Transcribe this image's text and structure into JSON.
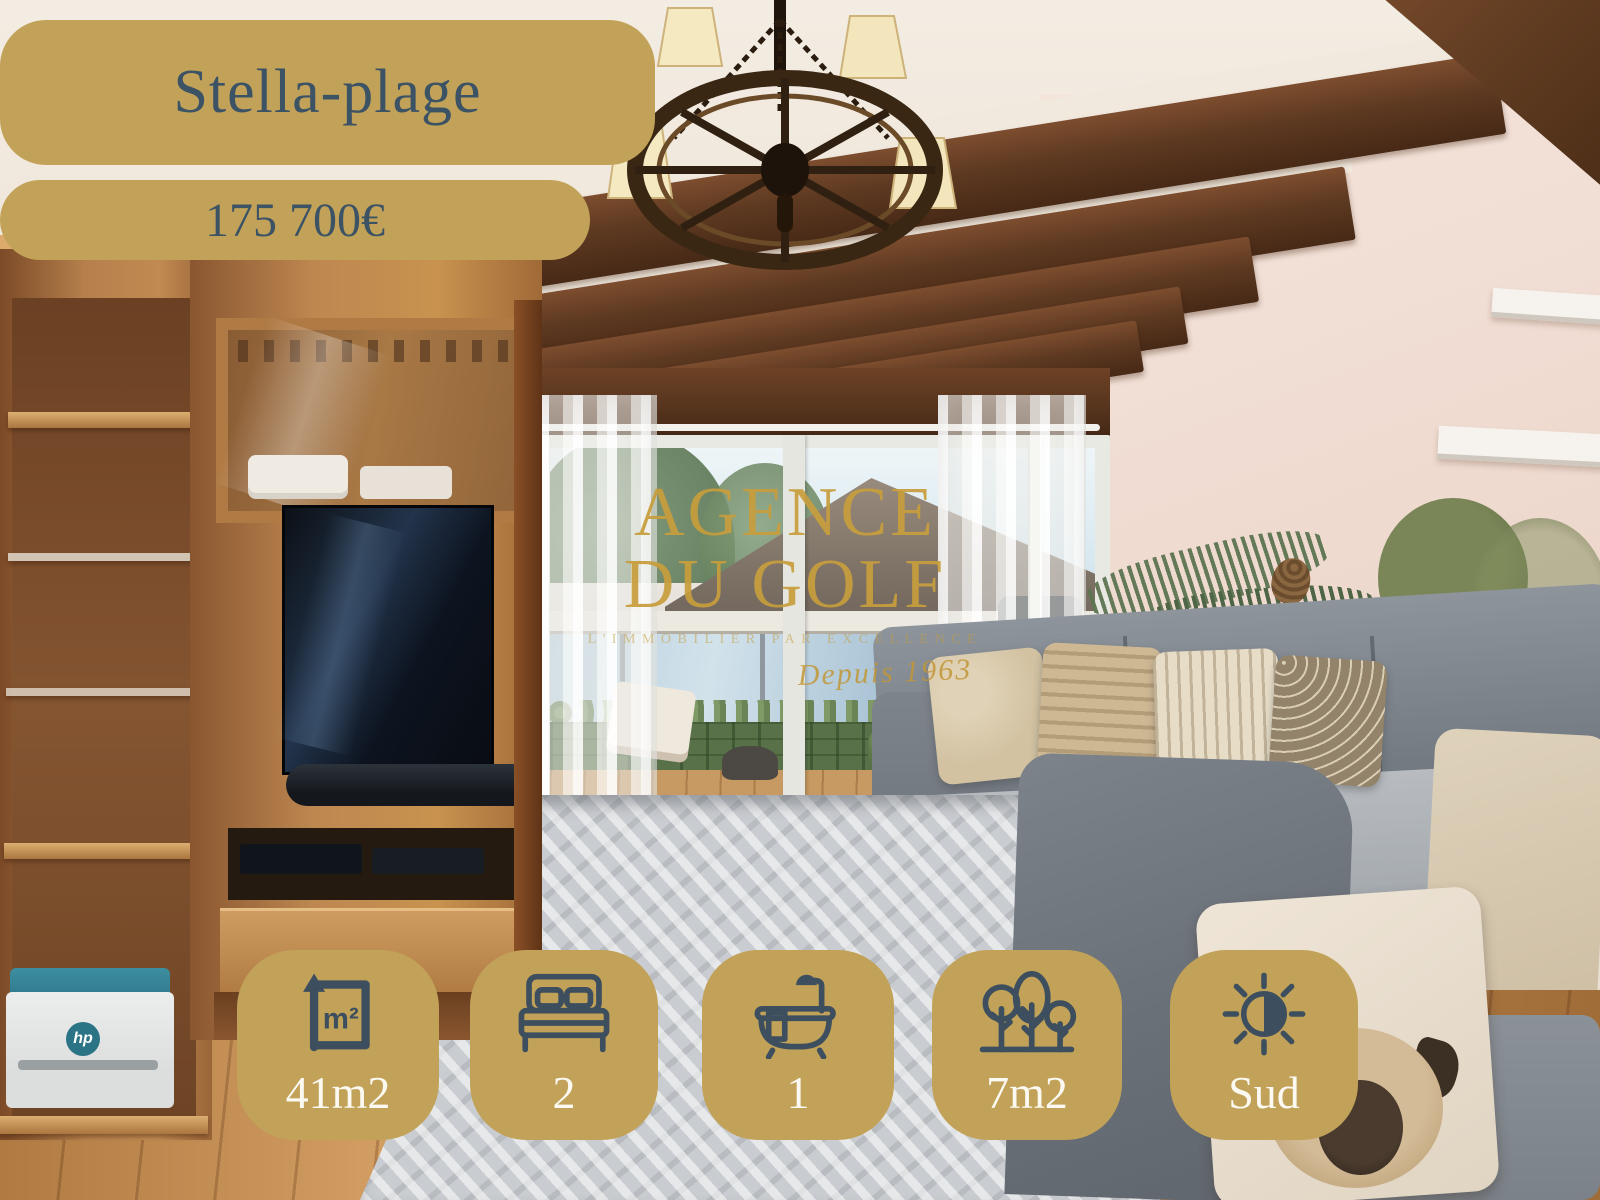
{
  "location": "Stella-plage",
  "price": "175 700€",
  "watermark": {
    "line1": "AGENCE",
    "line2": "DU GOLF",
    "tagline": "L'IMMOBILIER PAR EXCELLENCE",
    "since": "Depuis 1963"
  },
  "stats": {
    "items": [
      {
        "name": "surface",
        "icon": "surface-icon",
        "icon_text": "m²",
        "label": "41m2"
      },
      {
        "name": "bedrooms",
        "icon": "bed-icon",
        "label": "2"
      },
      {
        "name": "bathrooms",
        "icon": "bathtub-icon",
        "label": "1"
      },
      {
        "name": "garden",
        "icon": "trees-icon",
        "label": "7m2"
      },
      {
        "name": "orientation",
        "icon": "sun-icon",
        "label": "Sud"
      }
    ]
  },
  "photo": {
    "printer_logo": "hp"
  },
  "colors": {
    "badge_gold": "#c2a258",
    "badge_text_slate": "#3c5365",
    "stat_label_white": "#fbf9f2",
    "icon_slate": "#3d4f5e",
    "watermark_gold": "#c79d3c",
    "ceiling_plaster": "#f1e9de",
    "beam_brown": "#5d3921",
    "wall_pink": "#f0dcd2",
    "wood_unit": "#b5804c",
    "sofa_gray": "#7b828a",
    "rug_gray": "#c9ccd0"
  }
}
